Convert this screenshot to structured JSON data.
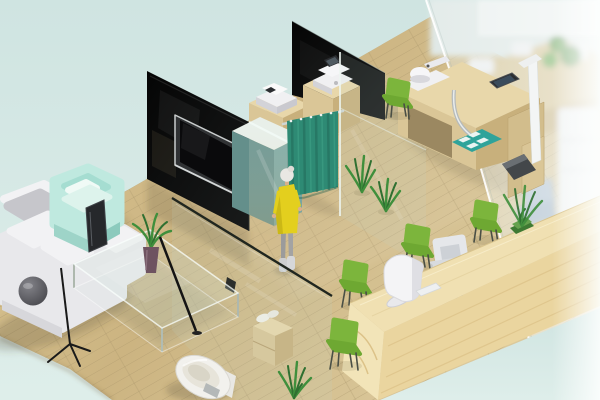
{
  "meta": {
    "description": "Isometric 3D rendering of a small clinic / optical-shop interior with waiting area, curtained exam space, equipment desks, reception counter and toilet cubicle",
    "width": 600,
    "height": 400,
    "visible_text": []
  },
  "palette": {
    "background": "#d3e6e2",
    "backgroundLight": "#e4f1ed",
    "floor": "#cfba8a",
    "floorLight": "#dbc795",
    "floorDark": "#cbb480",
    "plank": "#a8946a",
    "wallDark": "#070707",
    "woodTop": "#e8d7aa",
    "woodLeft": "#dac697",
    "woodRight": "#c8b07c",
    "counterTop": "#f0e0b2",
    "counterFront": "#ead59f",
    "counterEnd": "#f2e4b8",
    "counterGrain": "#dcc288",
    "tealCabinet": "#7aa5a0",
    "tealCabinetDark": "#648f8b",
    "tealCabinetTop": "#e8efe9",
    "curtain": "#2e8a74",
    "curtainDark": "#226b59",
    "curtainLight": "#3fa287",
    "rail": "#cfd6d4",
    "lime": "#7cb53c",
    "limeDark": "#6ea832",
    "chairLeg": "#4a4f45",
    "mint": "#bfe9df",
    "mintInner": "#a5ddd1",
    "mintFront": "#9ed4c8",
    "mintSide": "#8ccabd",
    "sofa": "#e8e8eb",
    "sofaCushion": "#c6c6cb",
    "sofaSeat": "#f2f2f4",
    "deviceWhite": "#f0f0f2",
    "deviceShade": "#d3d3d8",
    "screenDark": "#2b2d30",
    "skin": "#d9b08c",
    "hair": "#e9e7e3",
    "dressYellow": "#e3cf1e",
    "dressShade": "#c4b214",
    "legGray": "#9b9b9b",
    "bootGray": "#cdced0",
    "toiletWhite": "#f2f1ed",
    "chrome": "#b6bab9",
    "plantGreen": "#3f8f3c",
    "plantDark": "#2f7031",
    "vase": "#6e5360",
    "tealMat": "#2fa39a",
    "scaleBase": "#43474a",
    "blueChair": "#aebfd1"
  },
  "objects": [
    {
      "id": "background",
      "label": "Pale mint backdrop"
    },
    {
      "id": "wood-floor",
      "label": "Light wood plank floor"
    },
    {
      "id": "sectional-sofa",
      "label": "White sectional sofa with gray back cushions"
    },
    {
      "id": "mint-armchair",
      "label": "Mint green armchair with white pillow"
    },
    {
      "id": "glass-coffee-table",
      "label": "Glass coffee table with potted plant"
    },
    {
      "id": "tripod-floor-lamp",
      "label": "Black tripod floor lamp with gray sphere head"
    },
    {
      "id": "tv-partition-wall",
      "label": "Dark glass partition with wall-mounted TV"
    },
    {
      "id": "teal-sideboard",
      "label": "Teal sideboard behind glass half-partition"
    },
    {
      "id": "storage-cabinet-1",
      "label": "Wooden cabinet with white office device"
    },
    {
      "id": "storage-cabinet-2",
      "label": "Wooden cabinet with white office device"
    },
    {
      "id": "black-partition-wall",
      "label": "Black rear partition wall"
    },
    {
      "id": "privacy-curtain",
      "label": "Teal pleated privacy curtain on chrome rail"
    },
    {
      "id": "standing-person",
      "label": "Standing woman in yellow dress and gray leggings"
    },
    {
      "id": "floor-plant-1",
      "label": "Spiky green floor plant"
    },
    {
      "id": "floor-plant-2",
      "label": "Spiky green floor plant"
    },
    {
      "id": "toilet-room",
      "label": "Glass-walled toilet cubicle with towel shelf"
    },
    {
      "id": "toilet",
      "label": "White toilet"
    },
    {
      "id": "optometry-desk",
      "label": "Wooden equipment desk with white instruments and chrome tube"
    },
    {
      "id": "teal-floor-mat",
      "label": "Teal mat with white tiles"
    },
    {
      "id": "height-scale",
      "label": "White height measuring scale with dark platform"
    },
    {
      "id": "waiting-chair",
      "label": "Lime green side chair near rear wall"
    },
    {
      "id": "reception-counter",
      "label": "Long light-wood reception counter"
    },
    {
      "id": "reception-monitor",
      "label": "White monitor on reception counter"
    },
    {
      "id": "staff-office-chair",
      "label": "Light gray staff office chair"
    },
    {
      "id": "client-chairs",
      "label": "Four lime green client chairs along the counter"
    },
    {
      "id": "counter-plant-box",
      "label": "Green planter box on counter end"
    },
    {
      "id": "frosted-glass-wall",
      "label": "Frosted glass outer wall with blurred furniture behind"
    },
    {
      "id": "bottom-plant",
      "label": "Green bush beside toilet glass"
    },
    {
      "id": "side-plant",
      "label": "Leafy plant at right"
    }
  ]
}
